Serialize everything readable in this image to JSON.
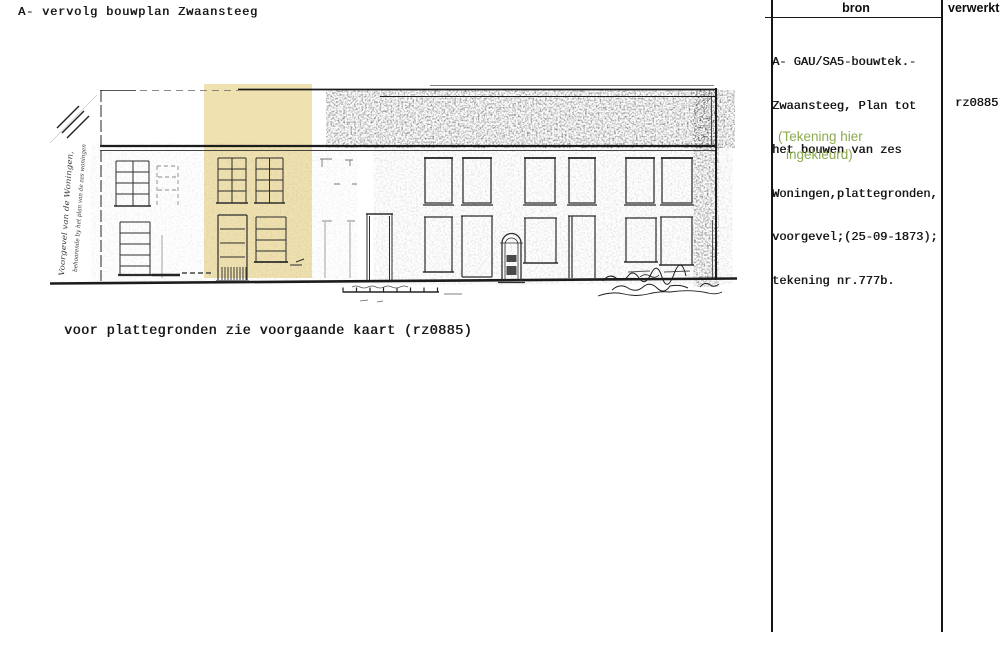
{
  "page_title": "A- vervolg bouwplan Zwaansteeg",
  "drawing": {
    "caption": "voor plattegronden zie voorgaande kaart (rz0885)",
    "highlight_color": "#f0e1b0",
    "left_annotation_line1": "Voorgevel van de Woningen,",
    "left_annotation_line2": "behoorende by het plan van de zes woningen"
  },
  "table": {
    "columns": [
      {
        "label": "bron"
      },
      {
        "label": "verwerkt"
      }
    ],
    "bron_lines": [
      "A- GAU/SA5-bouwtek.-",
      "Zwaansteeg, Plan tot",
      "het bouwen van zes",
      "Woningen,plattegronden,",
      "voorgevel;(25-09-1873);",
      "tekening nr.777b."
    ],
    "note_lines": [
      "(Tekening hier",
      "ingekleurd)"
    ],
    "note_color": "#8cab4f",
    "verwerkt_value": "rz0885"
  }
}
